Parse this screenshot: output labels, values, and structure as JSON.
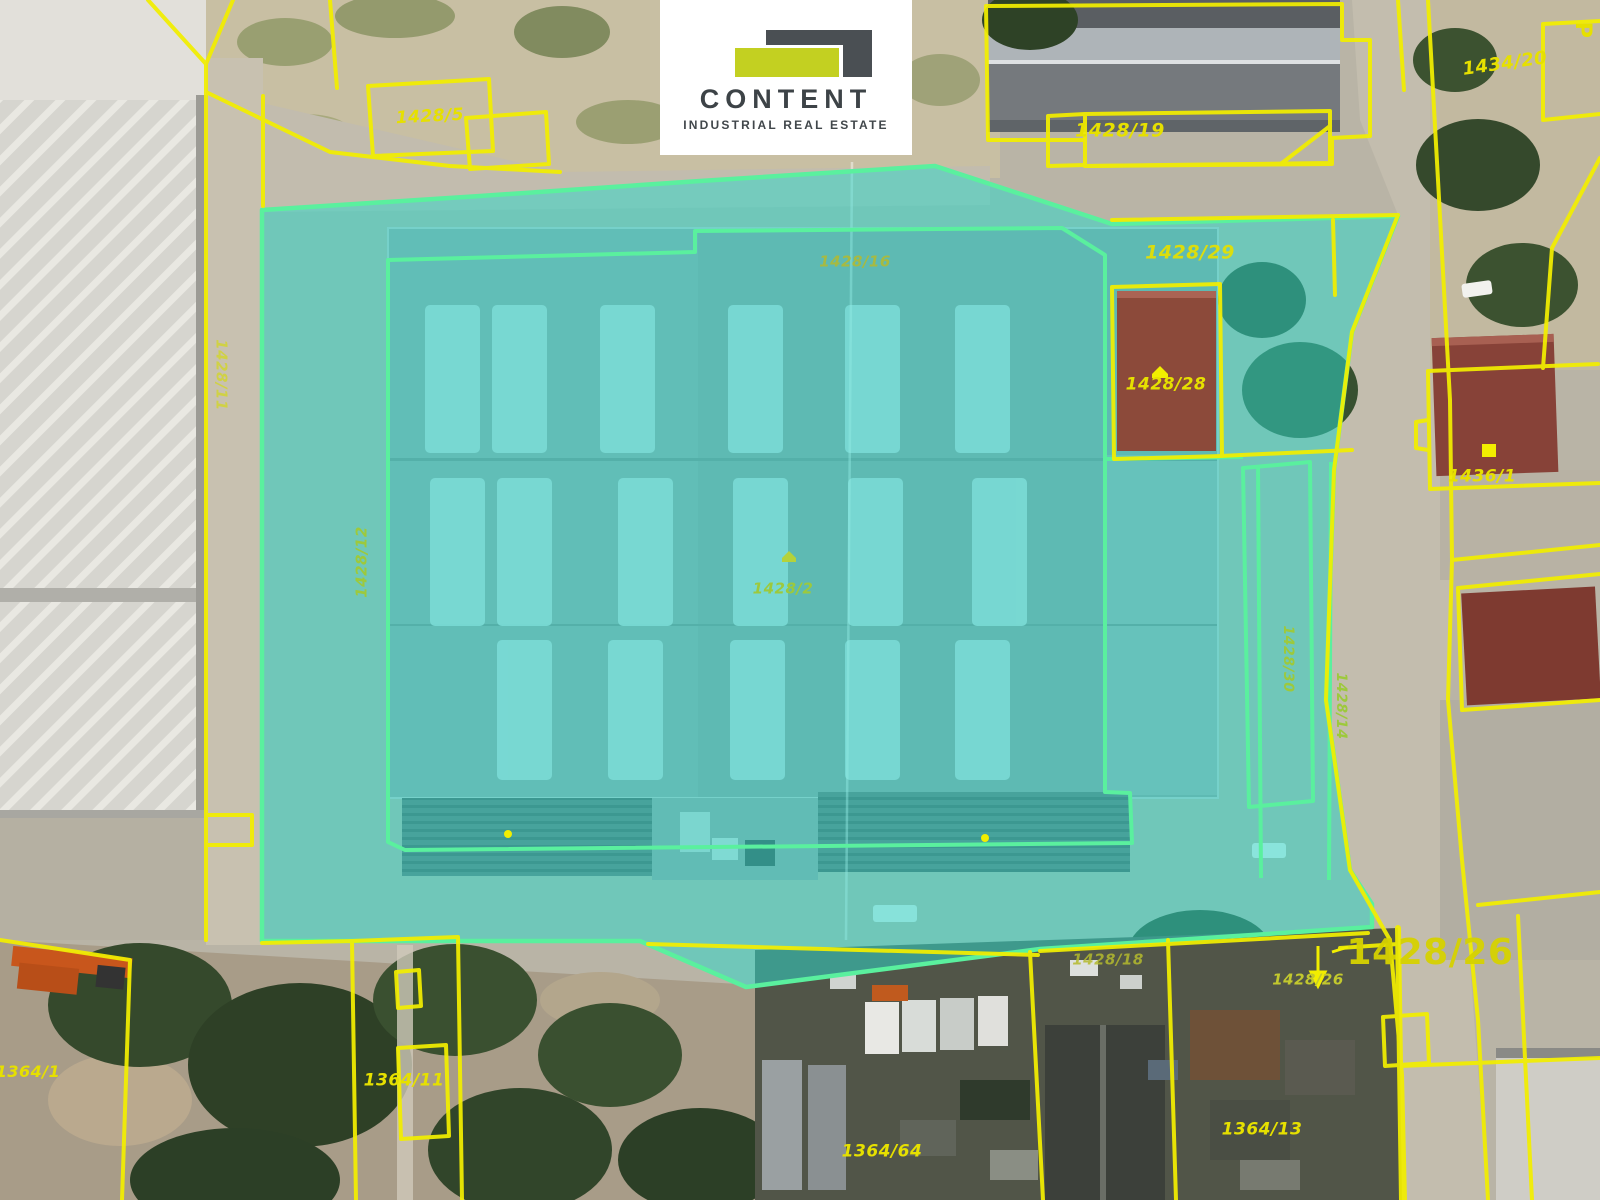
{
  "logo": {
    "name": "CONTENT",
    "tagline": "INDUSTRIAL REAL ESTATE",
    "accent_color": "#c3d021",
    "dark_color": "#4a4f53"
  },
  "map": {
    "type": "aerial-cadastral",
    "highlight_fill_color": "#2ed8cb",
    "highlight_border_color": "#5af09e",
    "parcel_line_color": "#f2ee00",
    "parcel_label_color": "#e6e000",
    "street_letter": "P",
    "parcels": [
      {
        "label": "1428/5"
      },
      {
        "label": "1428/19"
      },
      {
        "label": "1434/20"
      },
      {
        "label": "1428/29"
      },
      {
        "label": "1428/16"
      },
      {
        "label": "1428/11"
      },
      {
        "label": "1428/28"
      },
      {
        "label": "1436/1"
      },
      {
        "label": "1428/12"
      },
      {
        "label": "1428/2"
      },
      {
        "label": "1428/30"
      },
      {
        "label": "1428/14"
      },
      {
        "label": "1428/26"
      },
      {
        "label": "1428/26"
      },
      {
        "label": "1428/18"
      },
      {
        "label": "1364/1"
      },
      {
        "label": "1364/11"
      },
      {
        "label": "1364/64"
      },
      {
        "label": "1364/13"
      }
    ]
  }
}
